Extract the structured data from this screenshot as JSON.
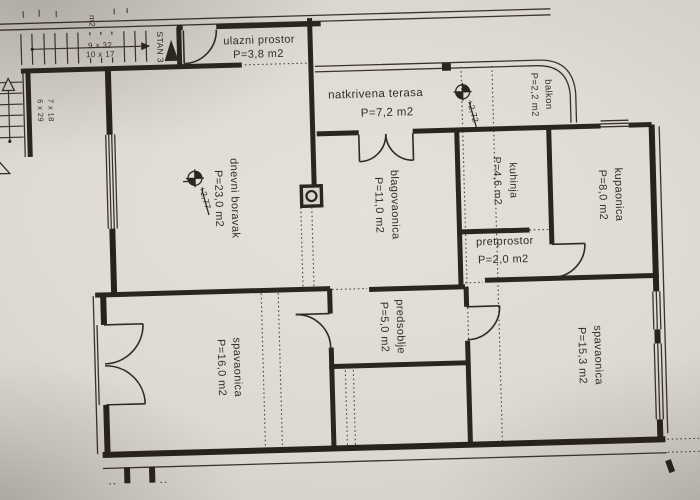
{
  "document": {
    "kind": "apartment floor plan photo"
  },
  "unit_label": "STAN 3",
  "rooms": [
    {
      "id": "ulazni-prostor",
      "name": "ulazni prostor",
      "area": "P=3,8 m2"
    },
    {
      "id": "natkrivena-terasa",
      "name": "natkrivena terasa",
      "area": "P=7,2 m2"
    },
    {
      "id": "balkon",
      "name": "balkon",
      "area": "P=2,2 m2"
    },
    {
      "id": "dnevni-boravak",
      "name": "dnevni boravak",
      "area": "P=23,0 m2"
    },
    {
      "id": "blagovaonica",
      "name": "blagovaonica",
      "area": "P=11,0 m2"
    },
    {
      "id": "kuhinja",
      "name": "kuhinja",
      "area": "P=4,6 m2"
    },
    {
      "id": "kupaonica",
      "name": "kupaonica",
      "area": "P=8,0 m2"
    },
    {
      "id": "pretprostor",
      "name": "pretprostor",
      "area": "P=2,0 m2"
    },
    {
      "id": "predsoblje",
      "name": "predsoblje",
      "area": "P=5,0 m2"
    },
    {
      "id": "spavaonica-west",
      "name": "spavaonica",
      "area": "P=16,0 m2"
    },
    {
      "id": "spavaonica-east",
      "name": "spavaonica",
      "area": "P=15,3 m2"
    }
  ],
  "stairs": {
    "top": {
      "line1": "9 x 32",
      "line2": "10 x 17"
    },
    "left": {
      "line1": "6 x 29",
      "line2": "7 x 18"
    }
  },
  "level_marks": {
    "living": "+2,77",
    "terrace": "+2,72"
  },
  "edge_text": {
    "fragment": "m2"
  },
  "colors": {
    "paper": "#d8d4cc",
    "ink": "#2a251e"
  }
}
